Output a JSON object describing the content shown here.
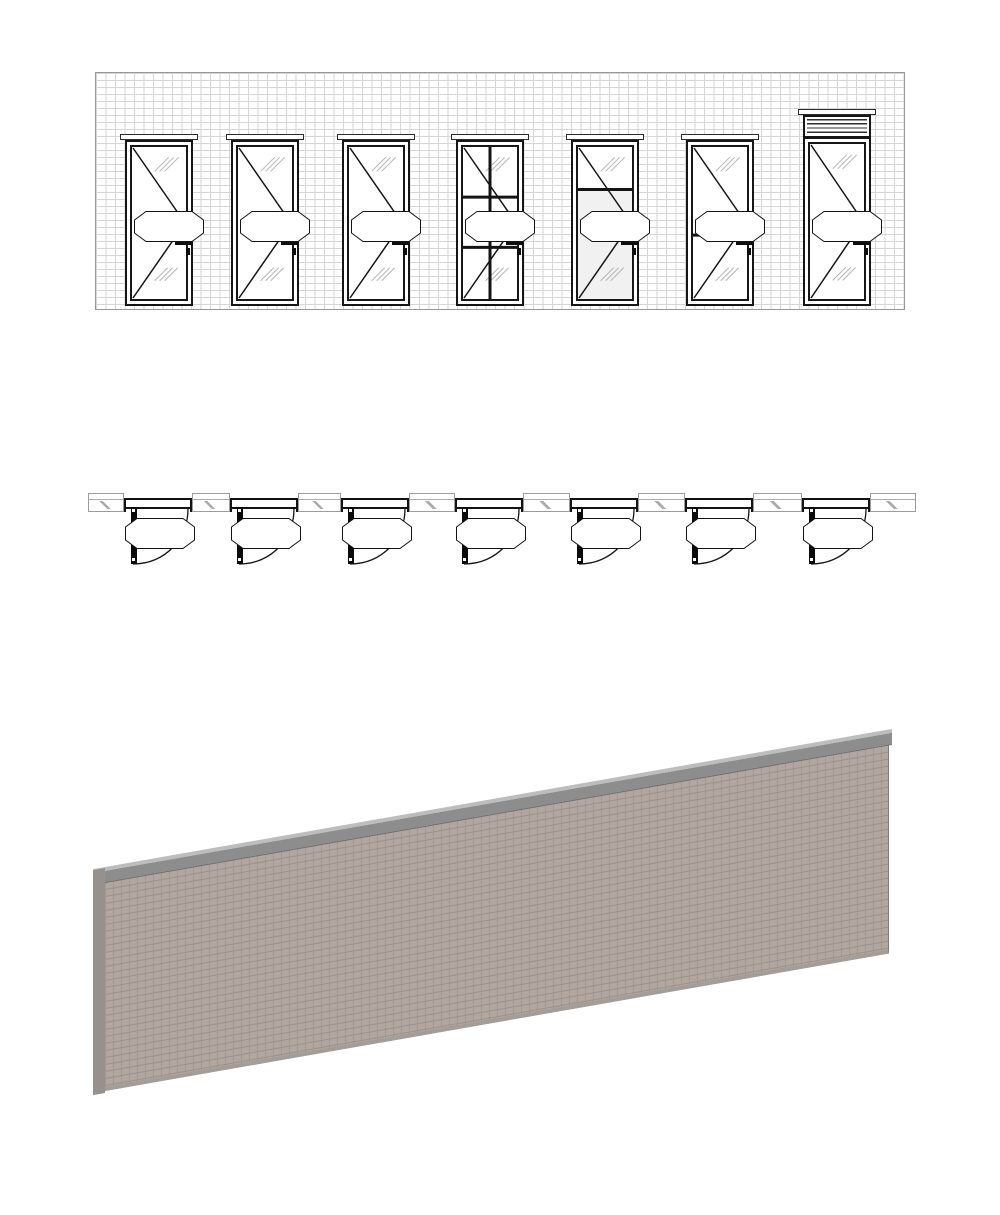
{
  "sheet": {
    "elevation": {
      "title": "1 SWING DOOR - ELEVATION",
      "scale": "1 : 50"
    },
    "plan": {
      "title": "1 SWING DOOR - PLAN",
      "scale": "1 : 50"
    },
    "three_d": {
      "title": "1 SWING DOOR - 3D",
      "wall_text": "1 SWING DOOR"
    }
  },
  "doors": [
    {
      "code": "WG.86",
      "type_tag": "WD-01.00",
      "style": "full-glass"
    },
    {
      "code": "WG.87",
      "type_tag": "WD-01.00",
      "style": "full-glass"
    },
    {
      "code": "WG.88",
      "type_tag": "WD-01.00",
      "style": "full-glass"
    },
    {
      "code": "WG.89",
      "type_tag": "WD-01.00",
      "style": "divided-6-lite"
    },
    {
      "code": "WG.90",
      "type_tag": "WD-01.00",
      "style": "glass-top-panel-bottom"
    },
    {
      "code": "WG.91",
      "type_tag": "WD-01.00",
      "style": "mid-rail"
    },
    {
      "code": "WG.92",
      "type_tag": "WD-01.00",
      "style": "louver-transom"
    }
  ],
  "colors": {
    "line": "#141414",
    "elev_mortar": "#d6d6d6",
    "glass_hatch": "#b5b5b5",
    "panel_elev": "#f1f1f1",
    "plan_gray": "#9c9c9c",
    "wall3d_brick": "#b1a6a0",
    "wall3d_mortar": "#9d9189",
    "wall3d_cap": "#8d8d8d",
    "glass3d": "#e6eff7",
    "glass3d_hatch": "#aabccb",
    "panel3d": "#d9dfe3"
  }
}
